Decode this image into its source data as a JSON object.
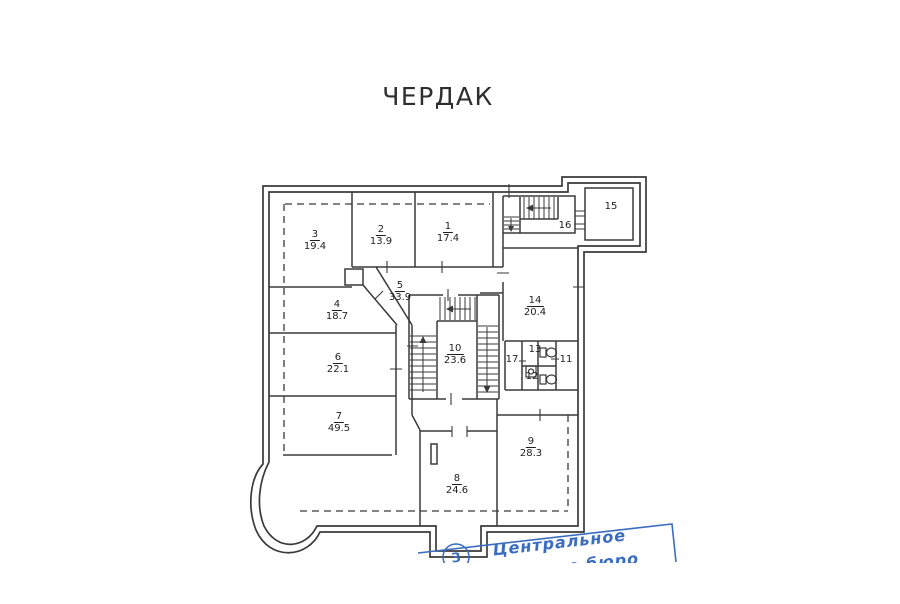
{
  "title": "ЧЕРДАК",
  "rooms": {
    "r1": {
      "number": "1",
      "area": "17.4"
    },
    "r2": {
      "number": "2",
      "area": "13.9"
    },
    "r3": {
      "number": "3",
      "area": "19.4"
    },
    "r4": {
      "number": "4",
      "area": "18.7"
    },
    "r5": {
      "number": "5",
      "area": "33.9"
    },
    "r6": {
      "number": "6",
      "area": "22.1"
    },
    "r7": {
      "number": "7",
      "area": "49.5"
    },
    "r8": {
      "number": "8",
      "area": "24.6"
    },
    "r9": {
      "number": "9",
      "area": "28.3"
    },
    "r10": {
      "number": "10",
      "area": "23.6"
    },
    "r11": {
      "number": "11"
    },
    "r12": {
      "number": "12"
    },
    "r13": {
      "number": "13"
    },
    "r14": {
      "number": "14",
      "area": "20.4"
    },
    "r15": {
      "number": "15"
    },
    "r16": {
      "number": "16"
    },
    "r17": {
      "number": "17"
    }
  },
  "stamp": {
    "line1": "Центральное",
    "line2_partial": "ное бюро",
    "seal_char": "З",
    "ink_color": "#3a6cc0"
  },
  "colors": {
    "wall": "#3a3a3a",
    "background": "#ffffff"
  }
}
